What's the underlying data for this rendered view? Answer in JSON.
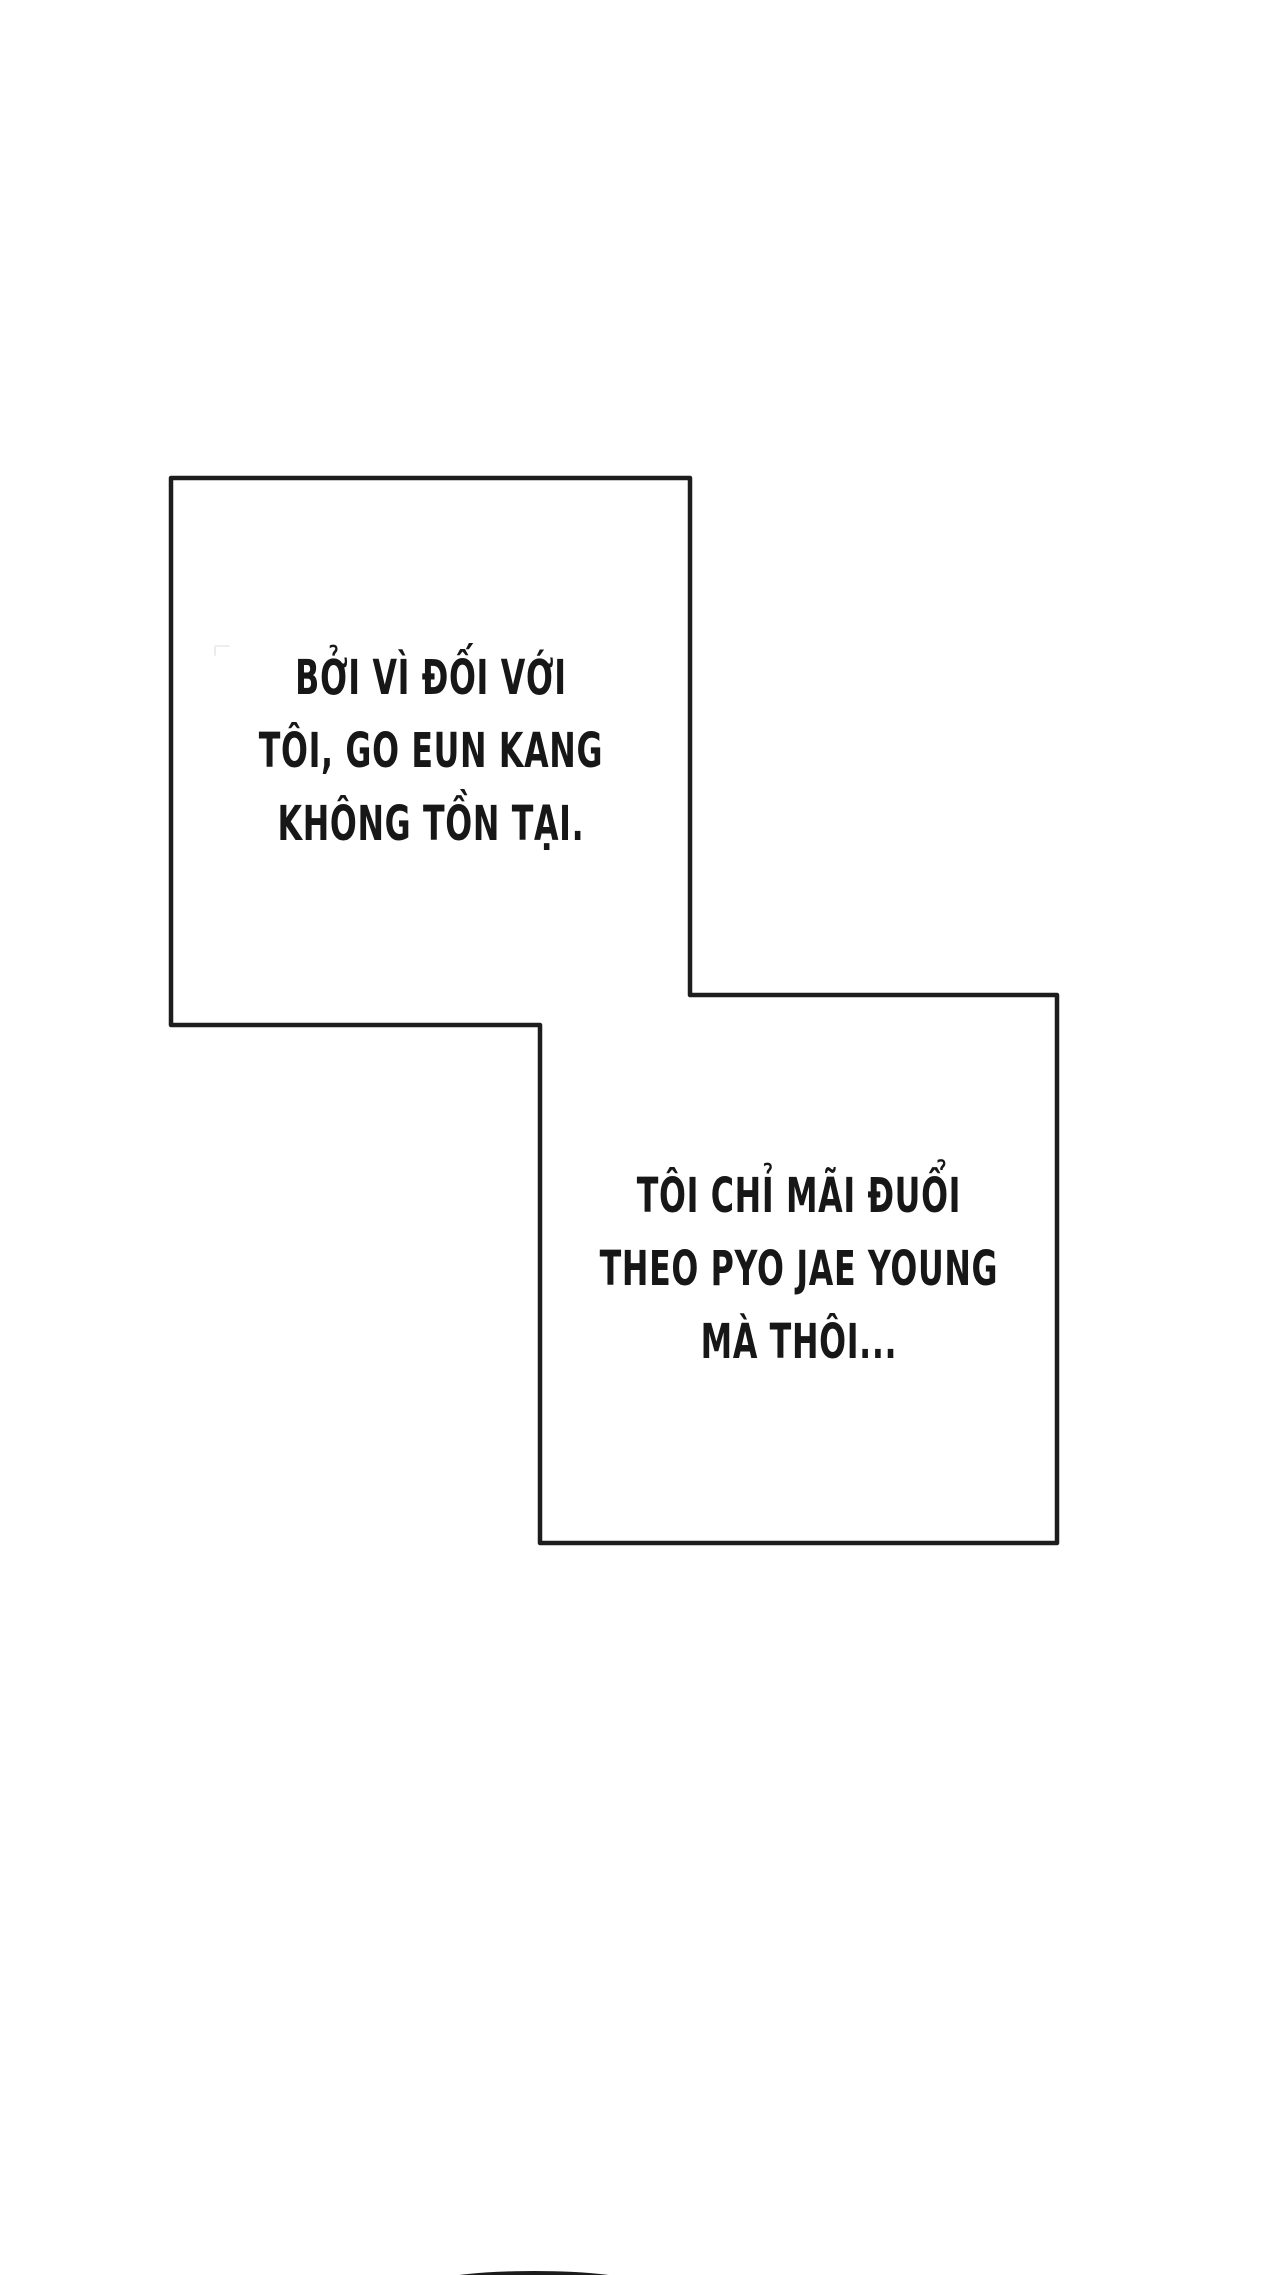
{
  "page": {
    "background_color": "#ffffff",
    "outline_color": "#1d1d1d",
    "outline_fill": "#ffffff",
    "text_color": "#171717",
    "peek_color": "#1c1c1c"
  },
  "panels": [
    {
      "name": "narration-box-1",
      "lines": [
        "BỞI VÌ ĐỐI VỚI",
        "TÔI, GO EUN KANG",
        "KHÔNG TỒN TẠI."
      ]
    },
    {
      "name": "narration-box-2",
      "lines": [
        "TÔI CHỈ MÃI ĐUỔI",
        "THEO PYO JAE YOUNG",
        "MÀ THÔI..."
      ]
    }
  ]
}
